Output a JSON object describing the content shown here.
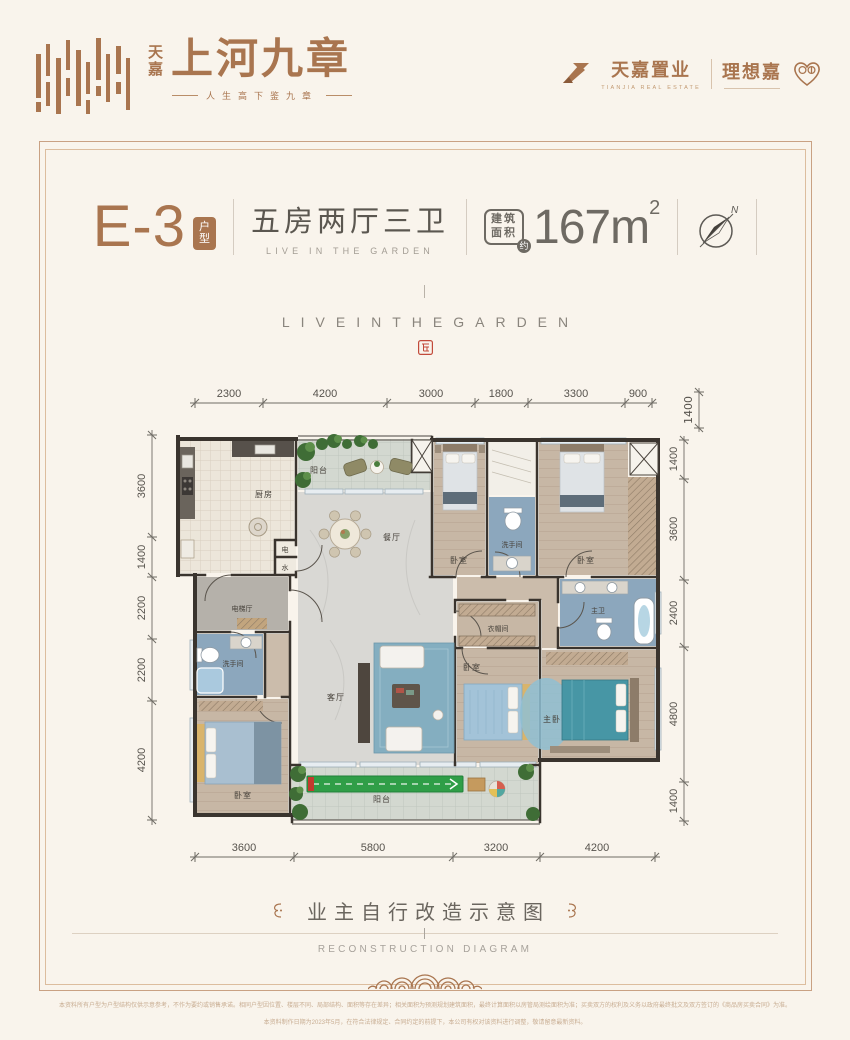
{
  "brand": {
    "logo_cn_small": "天嘉",
    "logo_cn_large": "上河九章",
    "tagline": "人生高下鉴九章",
    "dev_name": "天嘉置业",
    "dev_sub": "TIANJIA REAL ESTATE",
    "sub_brand": "理想嘉"
  },
  "header": {
    "unit_code": "E-3",
    "unit_badge": "户型",
    "rooms_title": "五房两厅三卫",
    "rooms_subtitle": "LIVE IN THE GARDEN",
    "area_label_line1": "建筑",
    "area_label_line2": "面积",
    "area_approx": "约",
    "area_value": "167m",
    "area_superscript": "2",
    "compass_north": "N"
  },
  "hero": {
    "spaced_title": "LIVEINTHEGARDEN"
  },
  "floorplan": {
    "dims_top": [
      "2300",
      "4200",
      "3000",
      "1800",
      "3300",
      "900"
    ],
    "dim_top_right": "1400",
    "dims_left": [
      "3600",
      "1400",
      "2200",
      "2200",
      "4200"
    ],
    "dims_right": [
      "1400",
      "3600",
      "2400",
      "4800",
      "1400"
    ],
    "dims_bottom": [
      "3600",
      "5800",
      "3200",
      "4200"
    ],
    "rooms": {
      "balcony": "阳台",
      "kitchen": "厨房",
      "dining": "餐厅",
      "bedroom": "卧室",
      "washroom": "洗手间",
      "master_bath": "主卫",
      "elevator_hall": "电梯厅",
      "electric": "电",
      "water": "水",
      "living": "客厅",
      "closet": "衣帽间",
      "master_bedroom": "主卧"
    }
  },
  "footer": {
    "title": "业主自行改造示意图",
    "subtitle": "RECONSTRUCTION DIAGRAM",
    "disclaimer_line1": "本资料所有户型为户型结构仅供示意参考，不作为要约或销售承诺。相同户型因位置、楼层不同、局部结构、面积等存在差异；相关面积为预测规划建筑面积，最终计算面积以房管局测绘面积为准；买卖双方的权利及义务以政府最终批文及双方签订的《商品房买卖合同》为准。",
    "disclaimer_line2": "本资料制作日期为2023年5月，在符合法律规定、合同约定的前提下，本公司有权对该资料进行调整，敬请留意最新资料。"
  },
  "colors": {
    "accent_brown": "#a9754f",
    "frame": "#c9a183",
    "seal_red": "#c24a3a"
  }
}
